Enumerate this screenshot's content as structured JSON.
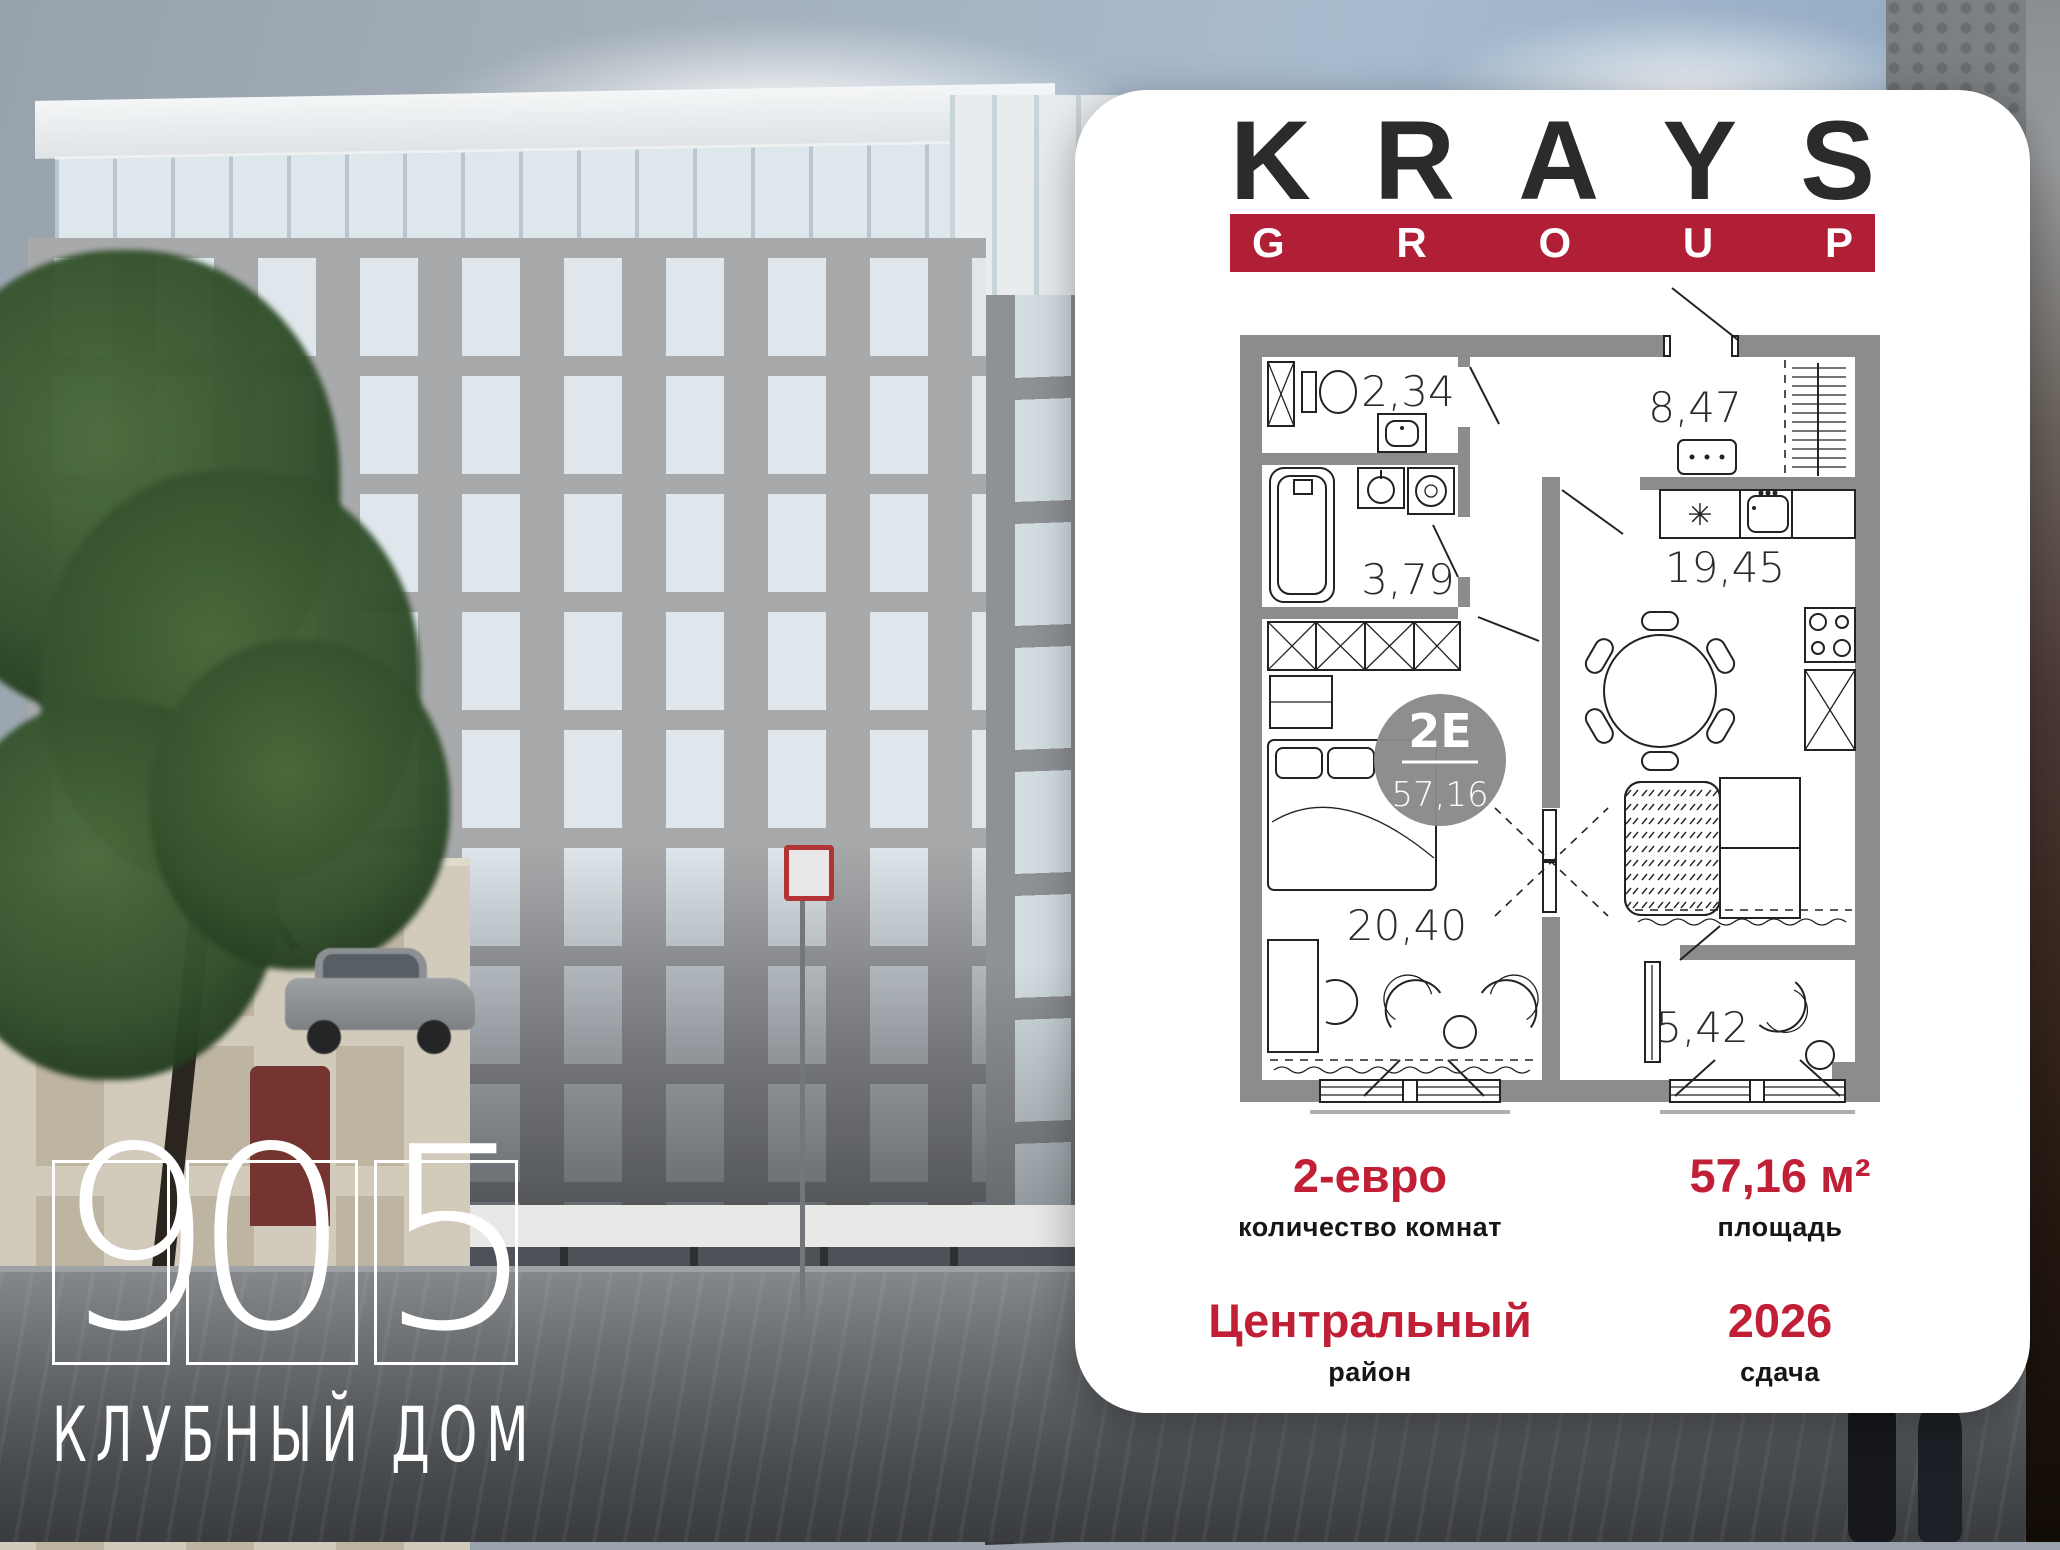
{
  "brand": {
    "name_top": "KRAYS",
    "name_bottom": "GROUP"
  },
  "residence": {
    "number_digits": [
      "9",
      "0",
      "5"
    ],
    "tagline": "КЛУБНЫЙ ДОМ"
  },
  "floorplan": {
    "badge": {
      "type": "2Е",
      "area": "57,16"
    },
    "rooms": {
      "toilet": "2,34",
      "hall": "8,47",
      "bathroom": "3,79",
      "kitchen_living": "19,45",
      "bedroom": "20,40",
      "balcony": "5,42"
    },
    "fridge_symbol": "✳"
  },
  "details": {
    "rooms": {
      "value": "2-евро",
      "label": "количество комнат"
    },
    "area": {
      "value": "57,16 м²",
      "label": "площадь"
    },
    "district": {
      "value": "Центральный",
      "label": "район"
    },
    "completion": {
      "value": "2026",
      "label": "сдача"
    }
  },
  "colors": {
    "accent_red_banner": "#b01f35",
    "accent_red_text": "#c01f36",
    "logo_dark": "#2d2a2b",
    "plan_wall_gray": "#8c8c8c",
    "badge_gray": "#8a8a8a"
  }
}
